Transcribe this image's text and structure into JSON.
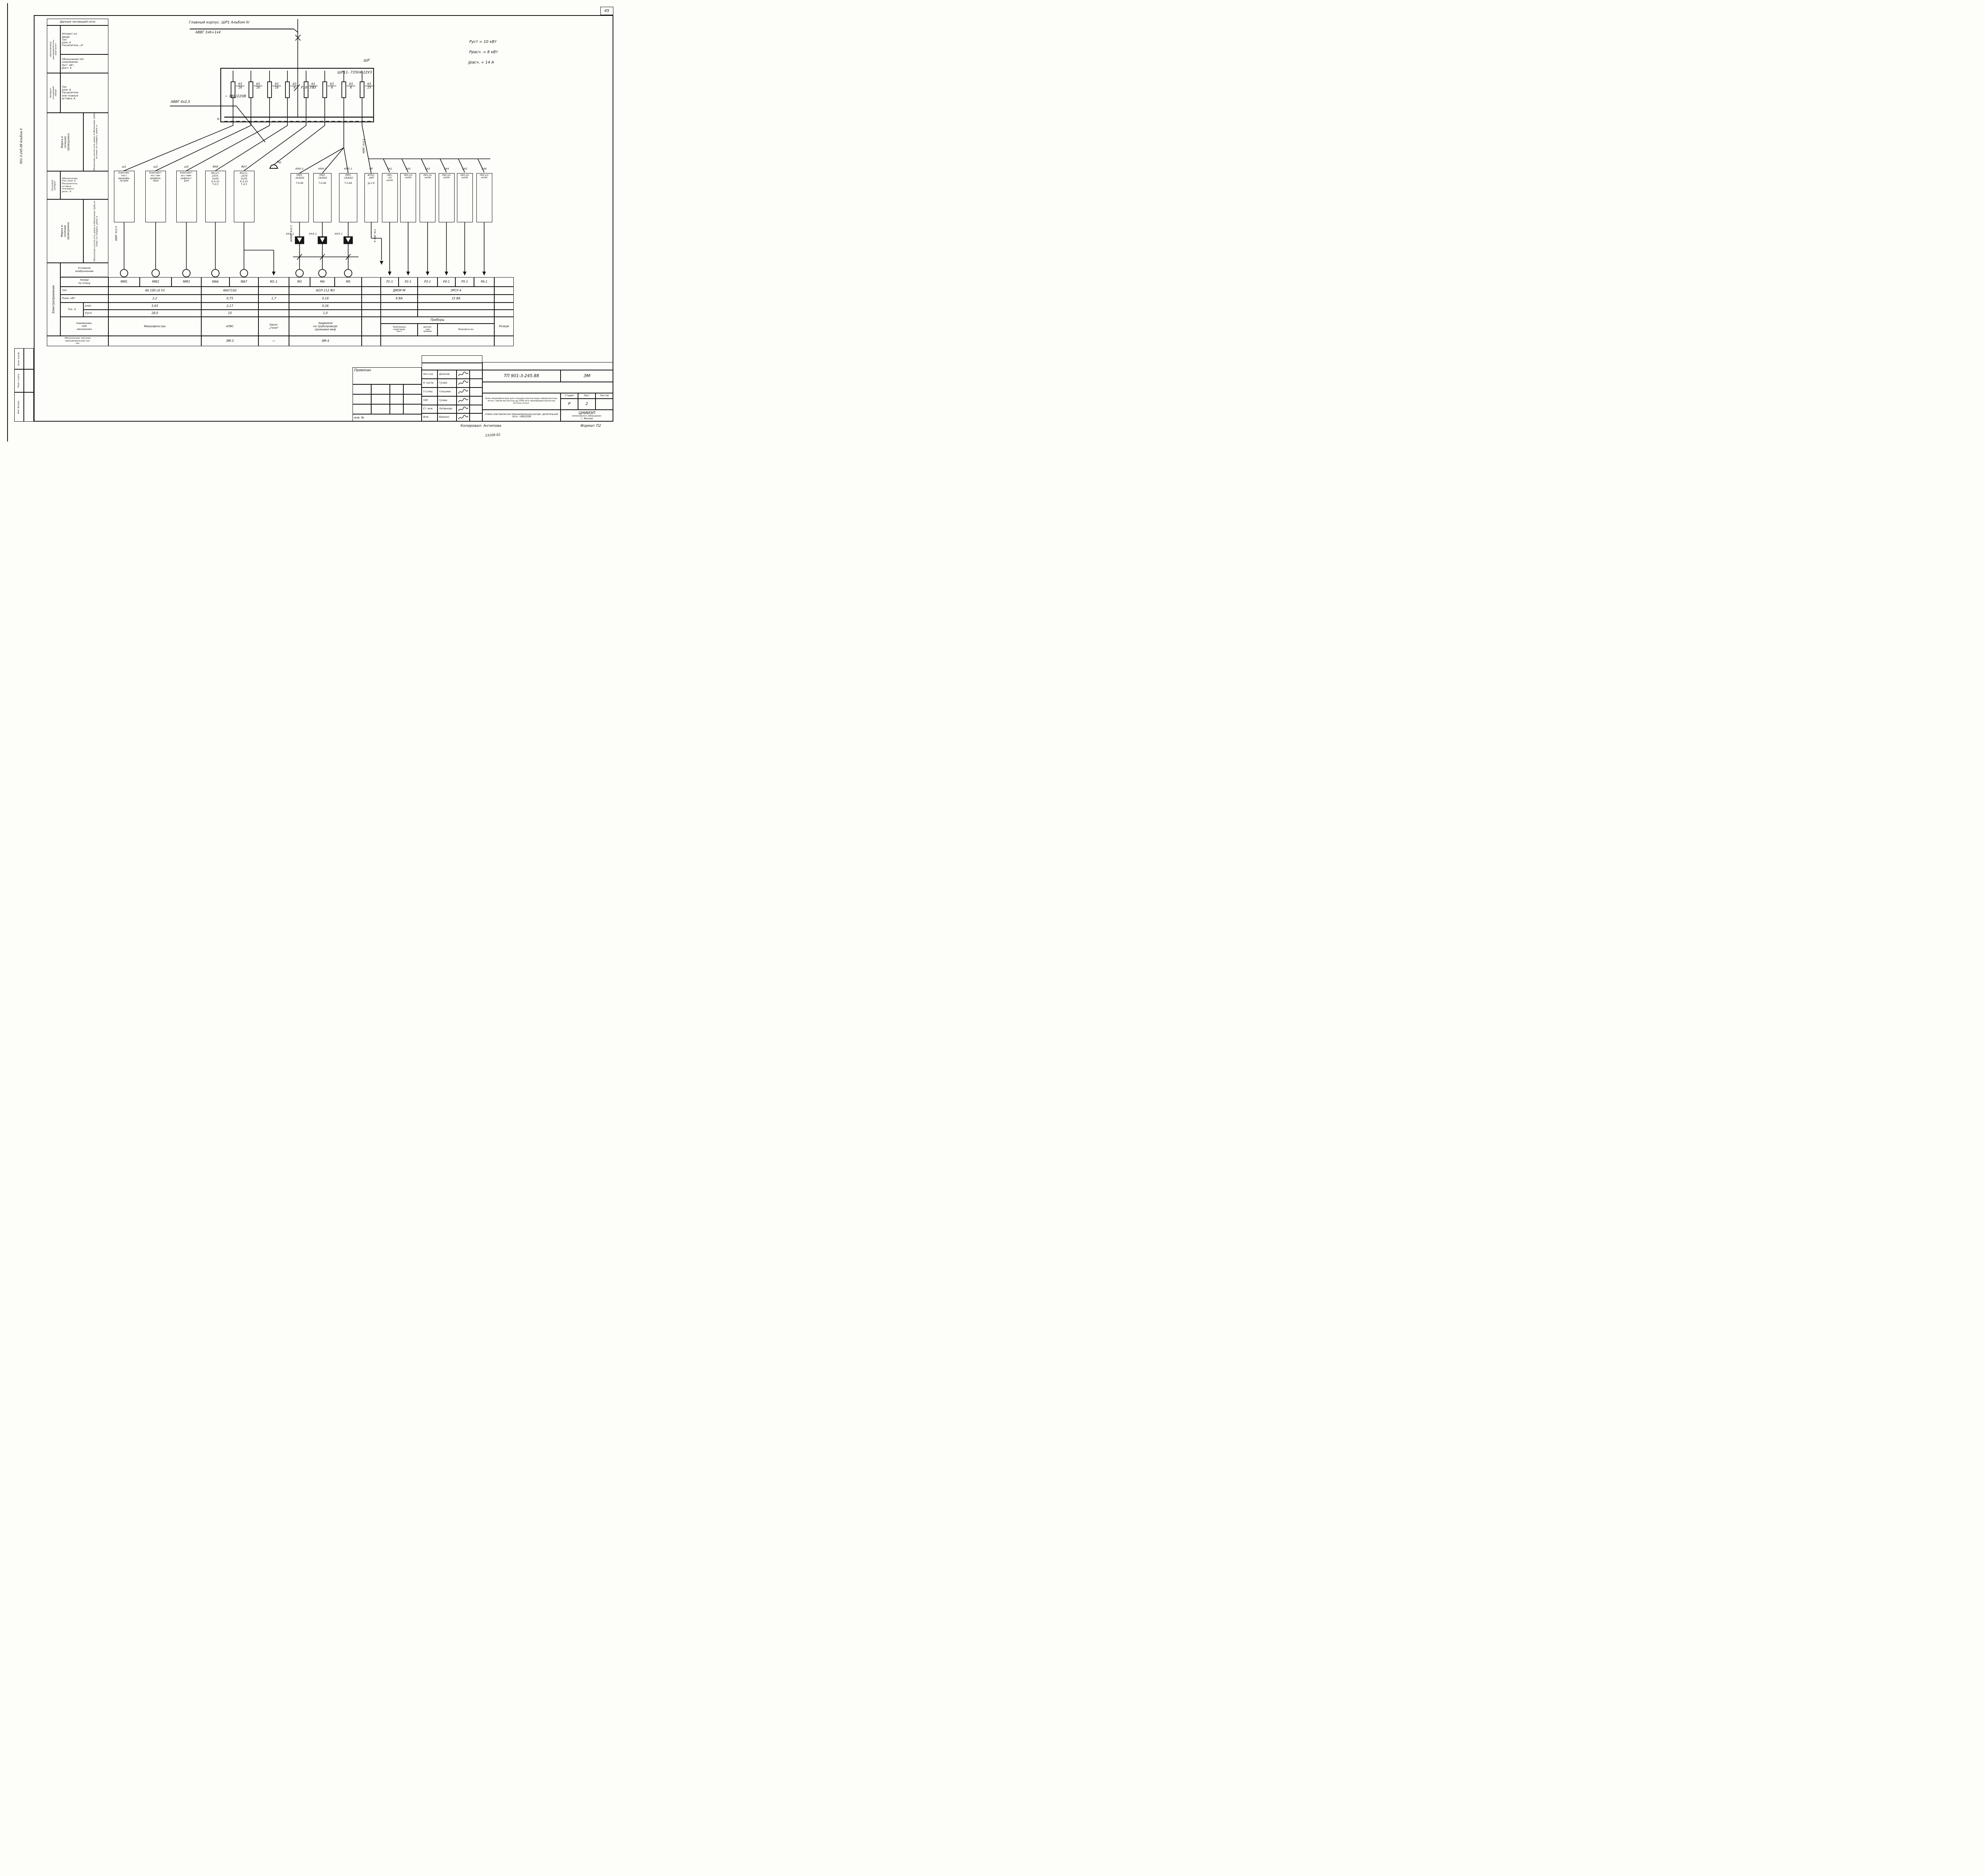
{
  "page": {
    "number": "45",
    "side_label": "901-3-245.88  Альбом II",
    "stamps": [
      "Взам. инв.№",
      "Подп. и дата",
      "Инв. №подл."
    ],
    "copied": "Копировал:  Антипова",
    "format": "Формат П2",
    "note": "23168-02"
  },
  "feeder": {
    "title": "Главный корпус. ШР1  Альбом IV",
    "cable": "АВВГ 3х6+1х4",
    "branch_cable": "АВВГ 4х2,5",
    "panel": "ШР",
    "panel_type": "ШР11- 73504-22У3",
    "meter": "Р18- 373",
    "voltage": "~ 380/220В",
    "neutral": "N",
    "info": [
      "Руст = 10 кВт",
      "Ррасч. = 8 кВт",
      "Jрасч. = 14 А"
    ]
  },
  "fuses": [
    {
      "top": "63",
      "bot": "16"
    },
    {
      "top": "63",
      "bot": "16"
    },
    {
      "top": "63",
      "bot": "16"
    },
    {
      "top": "63",
      "bot": "6"
    },
    {
      "top": "63",
      "bot": "6"
    },
    {
      "top": "63",
      "bot": "6"
    },
    {
      "top": "63",
      "bot": "6"
    },
    {
      "top": "63",
      "bot": "25"
    }
  ],
  "cables": {
    "sh1": "АВВГ 4х2,5",
    "kk": "АКВВГ 4х2,5",
    "qf": "АВВГ 4х2,5",
    "out": "К ВВГ 4х1"
  },
  "bell_label": "Рш",
  "starters": [
    {
      "label": "ш1",
      "text": "Комплек-\nтно с\nмикрофи-\nльтром"
    },
    {
      "label": "ш2",
      "text": "Комплект-\nно с ми-\nкрофиль-\nтром"
    },
    {
      "label": "ш3",
      "text": "Комплект-\nно с мик-\nрофильт-\nром"
    },
    {
      "label": "ЯА6",
      "text": "Я5111-\n2474-\nУхЛ4\nК-3,15\nТ-2,5"
    },
    {
      "label": "ЯА7",
      "text": "Я5111-\n-2474\nУхЛ4\nК-3,15\nТ-2,5"
    },
    {
      "label": "КМ3-1",
      "text": "ПМЛ-\n-163002\n\nТ-0,4А"
    },
    {
      "label": "КМ4-1",
      "text": "ПМЛ-\n-163002\n\nТ-0,4А"
    },
    {
      "label": "КМ5-1",
      "text": "ПМЛ-\n-163002\n\nТ-0,4А"
    },
    {
      "label": "QF",
      "text": "АП50-\n-2МТ\n\nJр-1,6"
    },
    {
      "label": "SA1",
      "text": "ПВЗ-\n-10/\n/м356"
    },
    {
      "label": "SA2",
      "text": "ПВЗ-10/\n/м356"
    },
    {
      "label": "SA3",
      "text": "ПВЗ-10/\n/м356"
    },
    {
      "label": "SA4",
      "text": "ПВЗ-10/\n/м356"
    },
    {
      "label": "SA5",
      "text": "ПВЗ-10/\n/м356"
    },
    {
      "label": "SA6",
      "text": "ПВЗ-10/\n/м356"
    }
  ],
  "relays": [
    "КК3-1",
    "КК4-1",
    "КК5-1"
  ],
  "sidebar": {
    "header": "Данные питающей сети",
    "g1rot": "Шинопровод\nраспределитель-\nный пункт",
    "g1a": "Аппарат на\nвводе\nТип\nJном. А\nРасцепитель „А“",
    "g1b": "Обозначение,тип\nнапряжение,\nРуст.  кВт,\nJрасч.  А",
    "g2rot": "Аппарат\nотходящей\nлинии",
    "g2a": "Тип\nJном. А\nРасцепитель\nили плавкая\nвставка, А",
    "markarot": "Марка и\nсечение\nпроводника",
    "markafine": "Обозначение участка сети; длина, м    Обозначение трубы на плане, по стандарту, длина, м",
    "g4rot": "Пусковой\nаппарат",
    "g4a": "Обозначение,\nТип; Jном. А\nРасцепитель;\nуставка\nтеплового\nреле , А",
    "g6rot": "Электроприемник",
    "sym": "Условное\nизображение",
    "plan": "Номер\nпо плану",
    "type": "тип",
    "pnom": "Рном.  кВт",
    "tok": "Ток. А",
    "inom": "Jном.",
    "ipusk": "Jпуск.",
    "mech": "Наименова-\nние\nмеханизма",
    "draw": "Обозначение чертежа\nпринципиальной схе-\nмы"
  },
  "table": {
    "plan": [
      "ММ1",
      "ММ2",
      "ММ3",
      "МА6",
      "МА7",
      "М1-1",
      "М3",
      "М4",
      "М5",
      "",
      "Р1-1",
      "Р2-1",
      "Р3-1",
      "Р4-1",
      "Р5-1",
      "Р6-1",
      ""
    ],
    "type": [
      {
        "s": 0,
        "e": 3,
        "t": "4А 100 L6 У3"
      },
      {
        "s": 3,
        "e": 5,
        "t": "4АХ71А2"
      },
      {
        "s": 5,
        "e": 6,
        "t": ""
      },
      {
        "s": 6,
        "e": 9,
        "t": "АОЛ-112 Ф3"
      },
      {
        "s": 9,
        "e": 10,
        "t": ""
      },
      {
        "s": 10,
        "e": 12,
        "t": "ДМЭР-М"
      },
      {
        "s": 12,
        "e": 16,
        "t": "ЭРСУ-4"
      },
      {
        "s": 16,
        "e": 17,
        "t": ""
      }
    ],
    "pnom": [
      {
        "s": 0,
        "e": 3,
        "t": "2,2"
      },
      {
        "s": 3,
        "e": 5,
        "t": "0,75"
      },
      {
        "s": 5,
        "e": 6,
        "t": "1,7"
      },
      {
        "s": 6,
        "e": 9,
        "t": "0,18"
      },
      {
        "s": 9,
        "e": 10,
        "t": ""
      },
      {
        "s": 10,
        "e": 12,
        "t": "8 ВА"
      },
      {
        "s": 12,
        "e": 16,
        "t": "15 ВА"
      },
      {
        "s": 16,
        "e": 17,
        "t": ""
      }
    ],
    "inom": [
      {
        "s": 0,
        "e": 3,
        "t": "5,65"
      },
      {
        "s": 3,
        "e": 5,
        "t": "2,17"
      },
      {
        "s": 5,
        "e": 6,
        "t": ""
      },
      {
        "s": 6,
        "e": 9,
        "t": "0,36"
      },
      {
        "s": 9,
        "e": 10,
        "t": ""
      },
      {
        "s": 10,
        "e": 12,
        "t": ""
      },
      {
        "s": 12,
        "e": 16,
        "t": ""
      },
      {
        "s": 16,
        "e": 17,
        "t": ""
      }
    ],
    "ipusk": [
      {
        "s": 0,
        "e": 3,
        "t": "28,0"
      },
      {
        "s": 3,
        "e": 5,
        "t": "10"
      },
      {
        "s": 5,
        "e": 6,
        "t": ""
      },
      {
        "s": 6,
        "e": 9,
        "t": "1,0"
      },
      {
        "s": 9,
        "e": 10,
        "t": ""
      },
      {
        "s": 10,
        "e": 12,
        "t": ""
      },
      {
        "s": 12,
        "e": 16,
        "t": ""
      },
      {
        "s": 16,
        "e": 17,
        "t": ""
      }
    ],
    "name": [
      {
        "s": 0,
        "e": 3,
        "t": "Микрофильтры"
      },
      {
        "s": 3,
        "e": 5,
        "t": "АПВС"
      },
      {
        "s": 5,
        "e": 6,
        "t": "Насос\n„Гном“"
      },
      {
        "s": 6,
        "e": 9,
        "t": "Задвижки\nна трубопроводе\nпромывки  мкф"
      },
      {
        "s": 9,
        "e": 10,
        "t": ""
      }
    ],
    "pribory": "Приборы",
    "pribory_cells": [
      {
        "s": 10,
        "e": 12,
        "t": "Трубопровод\nсырой воды\nпоз.1"
      },
      {
        "s": 12,
        "e": 13,
        "t": "дренаж-\nный\nприямок"
      },
      {
        "s": 13,
        "e": 16,
        "t": "Микрофильтры"
      }
    ],
    "reserve": "Резерв",
    "draw": [
      {
        "s": 0,
        "e": 3,
        "t": ""
      },
      {
        "s": 3,
        "e": 5,
        "t": "ЭМ-3"
      },
      {
        "s": 5,
        "e": 6,
        "t": "—"
      },
      {
        "s": 6,
        "e": 9,
        "t": "ЭМ-4"
      },
      {
        "s": 9,
        "e": 10,
        "t": ""
      },
      {
        "s": 10,
        "e": 16,
        "t": ""
      },
      {
        "s": 16,
        "e": 17,
        "t": ""
      }
    ]
  },
  "titleblock": {
    "bind": "Привязан",
    "inv": "инв. №",
    "doc": "ТП 901-3-245.88",
    "code": "ЭМ",
    "project": "Блок микрофильтров для станции очистки воды поверхностных источ- ников мутностью до 1500 мг/л производительностью 12,5тыс.м³/сут.",
    "sheet_title": "Схема электрическая принципиальная распре- делительной сети ~380/220В",
    "org1": "ЦНИИЭП",
    "org2": "инженерного оборудован.",
    "org3": "г. Москва",
    "stage_h": "Стадия",
    "sheet_h": "Лист",
    "sheets_h": "Листов",
    "stage": "Р",
    "sheet": "2",
    "sheets": "",
    "people": [
      {
        "role": "Нач отд",
        "name": "Данилов"
      },
      {
        "role": "Н. контр",
        "name": "Гусева"
      },
      {
        "role": "Гл.спец",
        "name": "Гольцман"
      },
      {
        "role": "ГИП",
        "name": "Гусева"
      },
      {
        "role": "Ст. инж",
        "name": "Литвинова"
      },
      {
        "role": "Инж.",
        "name": "Воронко"
      }
    ]
  }
}
